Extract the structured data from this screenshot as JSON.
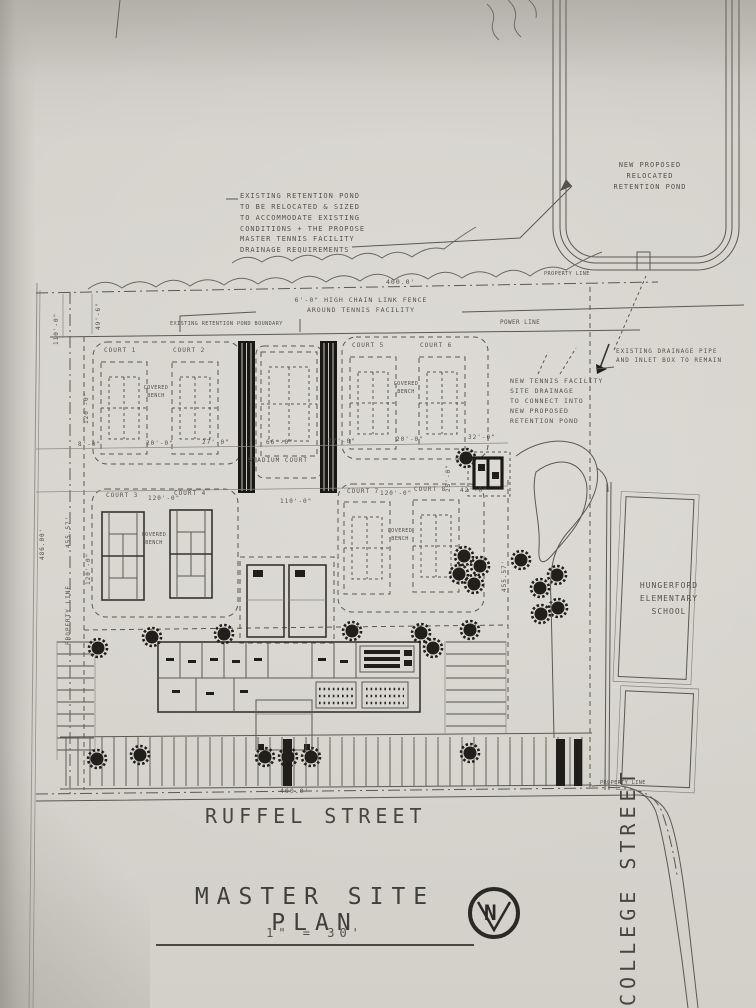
{
  "palette": {
    "paper": "#d4d1cb",
    "ink": "#55524c",
    "dark_fill": "#201e1a"
  },
  "notes": {
    "existing_pond": "EXISTING RETENTION POND\nTO BE RELOCATED & SIZED\nTO ACCOMMODATE EXISTING\nCONDITIONS + THE PROPOSE\nMASTER TENNIS FACILITY\nDRAINAGE REQUIREMENTS",
    "new_pond": "NEW PROPOSED\nRELOCATED\nRETENTION POND",
    "drainage_pipe": "EXISTING DRAINAGE PIPE\nAND INLET BOX TO REMAIN",
    "site_drainage": "NEW TENNIS FACILITY\nSITE DRAINAGE\nTO CONNECT INTO\nNEW PROPOSED\nRETENTION POND",
    "fence": "6'-0\" HIGH CHAIN LINK FENCE\nAROUND TENNIS FACILITY",
    "pond_boundary": "EXISTING RETENTION POND BOUNDARY",
    "power_line": "POWER LINE"
  },
  "property_line": {
    "top": "PROPERTY LINE",
    "left": "PROPERTY LINE",
    "bottom": "PROPERTY LINE"
  },
  "courts": {
    "c1": "COURT 1",
    "c2": "COURT 2",
    "c3": "COURT 3",
    "c4": "COURT 4",
    "c5": "COURT 5",
    "c6": "COURT 6",
    "c7": "COURT 7",
    "c8": "COURT 8",
    "stadium": "STADIUM COURT",
    "covered_bench": "COVERED\nBENCH"
  },
  "dimensions": {
    "top_width": "400.0'",
    "bottom_width": "400.0'",
    "left_110": "110'-0\"",
    "left_49": "49'-6\"",
    "row1_h": "120'-0\"",
    "row2_h": "120'-0\"",
    "d8": "8'-0\"",
    "d20a": "20'-0\"",
    "d27a": "27'-0\"",
    "d66": "66'-0\"",
    "d27b": "27'-0\"",
    "d20b": "20'-0\"",
    "d32": "32'-0\"",
    "d120a": "120'-0\"",
    "d110": "110'-0\"",
    "d120b": "120'-0\"",
    "d42": "42'-0\"",
    "d25": "25'-0\"",
    "left_486": "486.00'",
    "left_455": "455.57'",
    "right_455": "455.57'"
  },
  "buildings": {
    "school": "HUNGERFORD\nELEMENTARY\nSCHOOL"
  },
  "streets": {
    "bottom": "RUFFEL STREET",
    "right": "COLLEGE STREET"
  },
  "title_block": {
    "title": "MASTER SITE PLAN",
    "scale": "1\" = 30'"
  },
  "north_arrow": {
    "letter": "N"
  }
}
